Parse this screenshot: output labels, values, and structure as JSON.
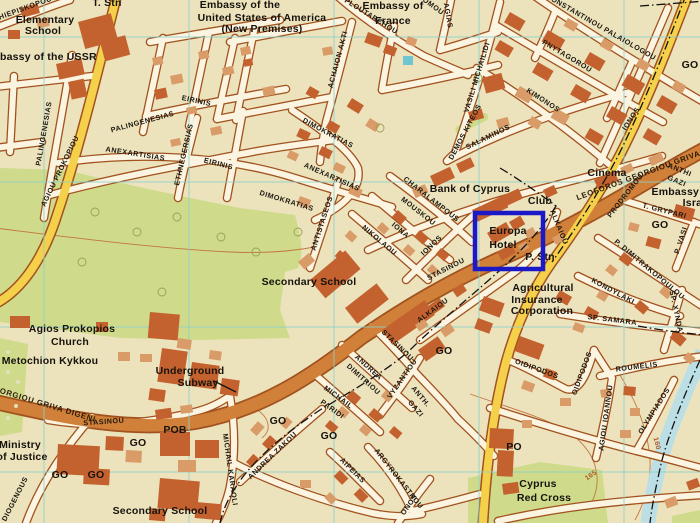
{
  "map": {
    "highlight_box": {
      "x": 475,
      "y": 213,
      "w": 68,
      "h": 56,
      "label_inside": "Europa Hotel"
    },
    "contour_values": [
      "165",
      "160"
    ],
    "labels": [
      {
        "t": "Elementary",
        "x": 45,
        "y": 23,
        "c": "pl",
        "s": 9.5
      },
      {
        "t": "School",
        "x": 43,
        "y": 34,
        "c": "pl",
        "s": 9.5
      },
      {
        "t": "Embassy of the USSR",
        "x": 40,
        "y": 60,
        "c": "pl",
        "s": 8.5
      },
      {
        "t": "Embassy of the",
        "x": 240,
        "y": 8,
        "c": "pl",
        "s": 8.5
      },
      {
        "t": "United States of America",
        "x": 262,
        "y": 21,
        "c": "pl",
        "s": 8.5
      },
      {
        "t": "(New Premises)",
        "x": 262,
        "y": 32,
        "c": "pl",
        "s": 7.5
      },
      {
        "t": "Embassy of",
        "x": 393,
        "y": 9,
        "c": "pl",
        "s": 8.5
      },
      {
        "t": "France",
        "x": 393,
        "y": 24,
        "c": "pl",
        "s": 8.5
      },
      {
        "t": "T. Stn",
        "x": 107,
        "y": 6,
        "c": "pl",
        "s": 7
      },
      {
        "t": "Bank of Cyprus",
        "x": 470,
        "y": 192,
        "c": "pl"
      },
      {
        "t": "Cinema",
        "x": 607,
        "y": 176,
        "c": "pl"
      },
      {
        "t": "Club",
        "x": 540,
        "y": 204,
        "c": "pl",
        "s": 10
      },
      {
        "t": "Europa",
        "x": 508,
        "y": 234,
        "c": "pl"
      },
      {
        "t": "Hotel",
        "x": 503,
        "y": 248,
        "c": "pl"
      },
      {
        "t": "P. Stn",
        "x": 540,
        "y": 260,
        "c": "pl",
        "s": 7
      },
      {
        "t": "Embassy of",
        "x": 682,
        "y": 195,
        "c": "pl",
        "s": 8
      },
      {
        "t": "Israel",
        "x": 697,
        "y": 206,
        "c": "pl",
        "s": 8
      },
      {
        "t": "Agricultural",
        "x": 543,
        "y": 291,
        "c": "pl"
      },
      {
        "t": "Insurance",
        "x": 537,
        "y": 303,
        "c": "pl"
      },
      {
        "t": "Corporation",
        "x": 542,
        "y": 314,
        "c": "pl"
      },
      {
        "t": "Secondary School",
        "x": 309,
        "y": 285,
        "c": "pl",
        "s": 11
      },
      {
        "t": "Agios Prokopios",
        "x": 72,
        "y": 332,
        "c": "pl"
      },
      {
        "t": "Church",
        "x": 70,
        "y": 345,
        "c": "pl"
      },
      {
        "t": "Metochion Kykkou",
        "x": 50,
        "y": 364,
        "c": "pl"
      },
      {
        "t": "Underground",
        "x": 190,
        "y": 374,
        "c": "pl"
      },
      {
        "t": "Subway",
        "x": 198,
        "y": 386,
        "c": "pl"
      },
      {
        "t": "Ministry",
        "x": 20,
        "y": 448,
        "c": "pl"
      },
      {
        "t": "of Justice",
        "x": 22,
        "y": 460,
        "c": "pl"
      },
      {
        "t": "POB",
        "x": 175,
        "y": 433,
        "c": "pl",
        "s": 10
      },
      {
        "t": "Secondary School",
        "x": 160,
        "y": 514,
        "c": "pl",
        "s": 11
      },
      {
        "t": "PO",
        "x": 514,
        "y": 450,
        "c": "pl",
        "s": 11
      },
      {
        "t": "Cyprus",
        "x": 538,
        "y": 487,
        "c": "pl"
      },
      {
        "t": "Red Cross",
        "x": 544,
        "y": 501,
        "c": "pl"
      },
      {
        "t": "GO",
        "x": 690,
        "y": 68,
        "c": "pl",
        "s": 10
      },
      {
        "t": "GO",
        "x": 660,
        "y": 228,
        "c": "pl",
        "s": 10
      },
      {
        "t": "GO",
        "x": 444,
        "y": 354,
        "c": "pl",
        "s": 10
      },
      {
        "t": "GO",
        "x": 278,
        "y": 424,
        "c": "pl",
        "s": 10
      },
      {
        "t": "GO",
        "x": 329,
        "y": 439,
        "c": "pl",
        "s": 10
      },
      {
        "t": "GO",
        "x": 138,
        "y": 446,
        "c": "pl",
        "s": 10
      },
      {
        "t": "GO",
        "x": 60,
        "y": 478,
        "c": "pl",
        "s": 10
      },
      {
        "t": "GO",
        "x": 96,
        "y": 478,
        "c": "pl",
        "s": 10
      },
      {
        "t": "ARCHIEPISKOPOU",
        "x": 18,
        "y": 13,
        "r": -20,
        "c": "st",
        "s": 6.8
      },
      {
        "t": "PALINGENESIAS",
        "x": 46,
        "y": 134,
        "r": -80,
        "c": "st"
      },
      {
        "t": "PALINGENESIAS",
        "x": 143,
        "y": 124,
        "r": -15,
        "c": "st"
      },
      {
        "t": "EIRINIS",
        "x": 196,
        "y": 103,
        "r": 12,
        "c": "st"
      },
      {
        "t": "EIRINIS",
        "x": 218,
        "y": 166,
        "r": 14,
        "c": "st"
      },
      {
        "t": "ETHNEGERSIAS",
        "x": 186,
        "y": 155,
        "r": -77,
        "c": "st"
      },
      {
        "t": "ANEXARTISIAS",
        "x": 135,
        "y": 156,
        "r": 9,
        "c": "st"
      },
      {
        "t": "ANEXARTISIAS",
        "x": 331,
        "y": 179,
        "r": 24,
        "c": "st"
      },
      {
        "t": "DIMOKRATIAS",
        "x": 327,
        "y": 135,
        "r": 28,
        "c": "st"
      },
      {
        "t": "DIMOKRATIAS",
        "x": 286,
        "y": 203,
        "r": 17,
        "c": "st"
      },
      {
        "t": "ANTISTASEOS",
        "x": 324,
        "y": 224,
        "r": -72,
        "c": "st"
      },
      {
        "t": "ACHAION AKTI",
        "x": 340,
        "y": 60,
        "r": -75,
        "c": "st"
      },
      {
        "t": "PLOUTARCHOU",
        "x": 370,
        "y": 18,
        "r": 32,
        "c": "st"
      },
      {
        "t": "OMOU",
        "x": 432,
        "y": 8,
        "r": 36,
        "c": "st"
      },
      {
        "t": "AGIAS",
        "x": 446,
        "y": 16,
        "r": 80,
        "c": "st"
      },
      {
        "t": "VASILI MICHAILIDI",
        "x": 479,
        "y": 78,
        "r": -73,
        "c": "st"
      },
      {
        "t": "KONSTANTINOU PALAIOLOGOU",
        "x": 600,
        "y": 29,
        "r": 30,
        "c": "st",
        "s": 7.4
      },
      {
        "t": "PNYTAGOROU",
        "x": 566,
        "y": 58,
        "r": 31,
        "c": "st"
      },
      {
        "t": "KIMONOS",
        "x": 542,
        "y": 102,
        "r": 33,
        "c": "st"
      },
      {
        "t": "IONOS",
        "x": 633,
        "y": 120,
        "r": -57,
        "c": "st"
      },
      {
        "t": "SALAMINOS",
        "x": 489,
        "y": 139,
        "r": -26,
        "c": "st"
      },
      {
        "t": "DEMOS KITEOS",
        "x": 467,
        "y": 133,
        "r": -62,
        "c": "st",
        "s": 4.2
      },
      {
        "t": "CHARALAMPOUS",
        "x": 430,
        "y": 201,
        "r": 38,
        "c": "st"
      },
      {
        "t": "MOUSKOU",
        "x": 417,
        "y": 213,
        "r": 38,
        "c": "st"
      },
      {
        "t": "IONA",
        "x": 399,
        "y": 232,
        "r": 40,
        "c": "st"
      },
      {
        "t": "NIKOLAOU",
        "x": 378,
        "y": 242,
        "r": 40,
        "c": "st"
      },
      {
        "t": "IONOS",
        "x": 433,
        "y": 247,
        "r": -44,
        "c": "st"
      },
      {
        "t": "STASINOU",
        "x": 447,
        "y": 271,
        "r": -27,
        "c": "st"
      },
      {
        "t": "ALKAIOU",
        "x": 557,
        "y": 228,
        "r": 68,
        "c": "st"
      },
      {
        "t": "ALKAIOU",
        "x": 434,
        "y": 312,
        "r": -36,
        "c": "st"
      },
      {
        "t": "PRODROMOU",
        "x": 627,
        "y": 197,
        "r": -52,
        "c": "st"
      },
      {
        "t": "P. DIMITRAKOPOULOU",
        "x": 648,
        "y": 271,
        "r": 40,
        "c": "st",
        "s": 6.8
      },
      {
        "t": "KONDYLAKI",
        "x": 612,
        "y": 293,
        "r": 28,
        "c": "st"
      },
      {
        "t": "SP. SAMARA",
        "x": 612,
        "y": 322,
        "r": 7,
        "c": "st"
      },
      {
        "t": "SP. XYNDA",
        "x": 674,
        "y": 312,
        "r": 78,
        "c": "st"
      },
      {
        "t": "T. GRYPARI",
        "x": 664,
        "y": 213,
        "r": 14,
        "c": "st"
      },
      {
        "t": "ANTHI",
        "x": 679,
        "y": 172,
        "r": 22,
        "c": "st",
        "s": 6.8
      },
      {
        "t": "GAZI",
        "x": 676,
        "y": 183,
        "r": 22,
        "c": "st",
        "s": 6.8
      },
      {
        "t": "P. VASI",
        "x": 683,
        "y": 241,
        "r": -72,
        "c": "st",
        "s": 6.5
      },
      {
        "t": "ANTH.",
        "x": 419,
        "y": 398,
        "r": 50,
        "c": "st"
      },
      {
        "t": "GAZI",
        "x": 414,
        "y": 410,
        "r": 50,
        "c": "st"
      },
      {
        "t": "VYZANTIOU",
        "x": 404,
        "y": 380,
        "r": -55,
        "c": "st"
      },
      {
        "t": "ANDREA",
        "x": 367,
        "y": 369,
        "r": 42,
        "c": "st"
      },
      {
        "t": "DIMITRIOU",
        "x": 362,
        "y": 381,
        "r": 42,
        "c": "st"
      },
      {
        "t": "MICHAIL",
        "x": 337,
        "y": 399,
        "r": 36,
        "c": "st"
      },
      {
        "t": "PARIDI",
        "x": 331,
        "y": 411,
        "r": 36,
        "c": "st"
      },
      {
        "t": "STASINOU",
        "x": 396,
        "y": 347,
        "r": 44,
        "c": "st"
      },
      {
        "t": "ANDREA ZAKOU",
        "x": 274,
        "y": 457,
        "r": -44,
        "c": "st"
      },
      {
        "t": "MICHAIL KARAOLI",
        "x": 228,
        "y": 470,
        "r": 82,
        "c": "st"
      },
      {
        "t": "AIPEIAS",
        "x": 351,
        "y": 472,
        "r": 45,
        "c": "st"
      },
      {
        "t": "ARGYROKASTROU",
        "x": 397,
        "y": 480,
        "r": 52,
        "c": "st"
      },
      {
        "t": "ONOS",
        "x": 411,
        "y": 506,
        "r": -55,
        "c": "st"
      },
      {
        "t": "OIDIPODOS",
        "x": 536,
        "y": 371,
        "r": 20,
        "c": "st"
      },
      {
        "t": "OIDIPODOS",
        "x": 584,
        "y": 374,
        "r": -70,
        "c": "st"
      },
      {
        "t": "ROUMELIS",
        "x": 637,
        "y": 369,
        "r": -7,
        "c": "st"
      },
      {
        "t": "AGIOU IOANNOU",
        "x": 608,
        "y": 418,
        "r": -82,
        "c": "st"
      },
      {
        "t": "OLYMPIADOS",
        "x": 656,
        "y": 412,
        "r": -58,
        "c": "st"
      },
      {
        "t": "STASINOU",
        "x": 104,
        "y": 424,
        "r": -4,
        "c": "st"
      },
      {
        "t": "DIOGENOUS",
        "x": 17,
        "y": 500,
        "r": -63,
        "c": "st"
      },
      {
        "t": "AGIOU PROKOPIOU",
        "x": 62,
        "y": 172,
        "r": -64,
        "c": "st"
      },
      {
        "t": "LEOFOROS GEORGIOU GRIVA DIGENI",
        "x": 655,
        "y": 172,
        "r": -20,
        "c": "rd"
      },
      {
        "t": "LEOFOROS GEORGIOU GRIVA DIGENI",
        "x": 16,
        "y": 398,
        "r": 17,
        "c": "rd"
      },
      {
        "t": "165",
        "x": 592,
        "y": 477,
        "r": -35,
        "c": "ct"
      },
      {
        "t": "160",
        "x": 655,
        "y": 444,
        "r": 75,
        "c": "ct"
      }
    ]
  },
  "colors": {
    "paper": "#ece3bd",
    "casing": "#a2521f",
    "roadwhite": "#faf4e0",
    "roadmain": "#d08038",
    "roadyellow": "#f5d04b",
    "green": "#cfdb8b",
    "grid": "#8ed1cc",
    "river": "#bcdfe6",
    "bdark": "#c4622f",
    "blight": "#d99c68",
    "contour": "#c06a33",
    "highlight": "#1b18c8"
  }
}
